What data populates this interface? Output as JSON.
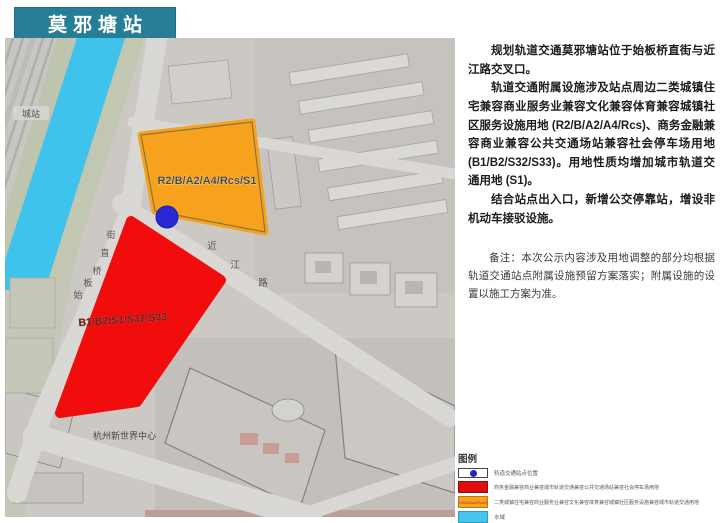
{
  "title": "莫邪塘站",
  "colors": {
    "banner": "#267d96",
    "parcel_red": "#f20d0d",
    "parcel_orange": "#f6a21c",
    "water": "#3fc3ec",
    "station_dot": "#2a2ad4",
    "legend_red": "#e00d0d",
    "legend_orange": "#f6a21c",
    "legend_water": "#45c6ec"
  },
  "map": {
    "railway_station_label": "城站",
    "street_vertical_name": "始板桥直街",
    "street_vertical_chars": [
      "始",
      "板",
      "桥",
      "直",
      "街"
    ],
    "street_diagonal_name": "近江路",
    "street_diagonal_chars": [
      "近",
      "江",
      "路"
    ],
    "orange_parcel_label": "R2/B/A2/A4/Rcs/S1",
    "red_parcel_label": "B1/B2/S1/S32/S33",
    "landmark_label": "杭州新世界中心"
  },
  "description": {
    "p1": "规划轨道交通莫邪塘站位于始板桥直街与近江路交叉口。",
    "p2": "轨道交通附属设施涉及站点周边二类城镇住宅兼容商业服务业兼容文化兼容体育兼容城镇社区服务设施用地 (R2/B/A2/A4/Rcs)、商务金融兼容商业兼容公共交通场站兼容社会停车场用地 (B1/B2/S32/S33)。用地性质均增加城市轨道交通用地 (S1)。",
    "p3": "结合站点出入口，新增公交停靠站，增设非机动车接驳设施。",
    "note": "备注：本次公示内容涉及用地调整的部分均根据轨道交通站点附属设施预留方案落实；附属设施的设置以施工方案为准。"
  },
  "legend": {
    "title": "图例",
    "items": [
      {
        "label": "轨道交通站点位置",
        "type": "station"
      },
      {
        "label": "商务金融兼容商业兼容城市轨道交通兼容公共交通场站兼容社会停车场用地",
        "type": "red"
      },
      {
        "label": "二类城镇住宅兼容商业服务业兼容文化兼容体育兼容城镇社区服务设施兼容城市轨道交通用地",
        "type": "orange",
        "inner": "R2/B/A2/A4/Rcs/S1"
      },
      {
        "label": "水域",
        "type": "water"
      }
    ]
  }
}
